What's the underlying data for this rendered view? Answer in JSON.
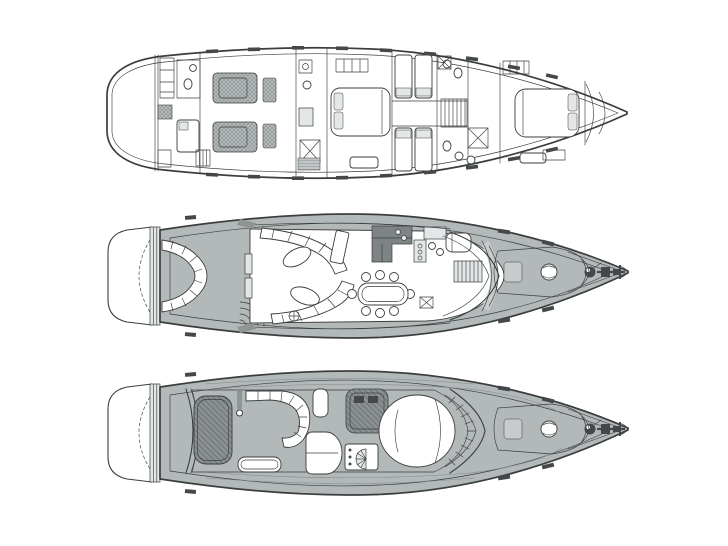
{
  "page": {
    "title": "Motor yacht deck plans - three deck layout line drawing, bow facing right",
    "background": "#ffffff"
  },
  "palette": {
    "line": "#3b3e3f",
    "line_soft": "#868b8c",
    "ink": "#44484a",
    "white": "#ffffff",
    "light": "#e4e7e7",
    "mid": "#c7cbcb",
    "mid_dark": "#8f9495",
    "dark_block": "#7e8485",
    "bulwark": "#b3b8b8",
    "teak_bg": "#c2c6c6",
    "teak_line": "#9aa0a0",
    "pad_bg": "#a3a8a9",
    "pad_line": "#7d8384",
    "pad_dark_bg": "#8b9192",
    "pad_dark_line": "#666c6d",
    "floor_bg": "#bcc0c1",
    "floor_line": "#a2a7a8"
  },
  "diagram": {
    "type": "yacht-deck-plan",
    "orientation": "bow-right",
    "views": [
      {
        "id": "lower-deck",
        "position": "top",
        "features": [
          "crew-cabin",
          "crew-bathroom",
          "engine-room-twin-engines",
          "port-bathroom",
          "master-stateroom",
          "twin-guest-cabin-port",
          "twin-guest-cabin-starboard",
          "central-staircase",
          "guest-bathrooms",
          "vip-bow-stateroom",
          "bow-chain-locker",
          "hull-portlights"
        ]
      },
      {
        "id": "main-deck",
        "position": "middle",
        "features": [
          "swim-platform",
          "transom-steps",
          "aft-cockpit-seating",
          "cockpit-teak-deck",
          "flybridge-stairs",
          "salon-curved-sofas",
          "cocktail-tables",
          "tv-cabinet",
          "galley",
          "dining-table-with-chairs",
          "companionway-stairs",
          "helm-seat",
          "helm-console",
          "wraparound-windscreen",
          "side-decks",
          "foredeck-sunpad",
          "deck-hatch",
          "anchor-windlass",
          "anchor",
          "bow-cleats"
        ]
      },
      {
        "id": "flybridge",
        "position": "bottom",
        "features": [
          "swim-platform",
          "transom-steps",
          "flybridge-overhang",
          "aft-sunpad",
          "c-shaped-settee",
          "drinks-table",
          "radar-mast",
          "helm-seats",
          "helm-console",
          "wet-bar-grill",
          "forward-sunlounger",
          "windscreen-frame",
          "coachroof-lines",
          "foredeck-sunpad",
          "deck-hatch",
          "anchor-windlass",
          "anchor"
        ]
      }
    ]
  }
}
